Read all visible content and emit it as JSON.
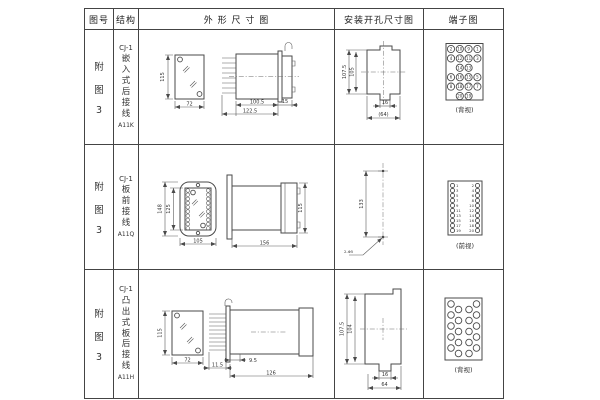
{
  "header": {
    "figure_col": "图号",
    "structure_col": "结构",
    "outline_col": "外 形 尺 寸 图",
    "mounting_col": "安装开孔尺寸图",
    "terminal_col": "端子图"
  },
  "rows": [
    {
      "figure": [
        "附",
        "图",
        "3"
      ],
      "structure": {
        "model": "CJ-1",
        "chars": [
          "嵌",
          "入",
          "式",
          "后",
          "接",
          "线"
        ],
        "code": "A11K"
      },
      "outline": {
        "front_height": "115",
        "front_width": "72",
        "side_top": "100.5",
        "side_bottom": "122.5",
        "side_right": "15"
      },
      "mounting": {
        "outer_height": "107.5",
        "inner_height": "105",
        "slot_width": "16",
        "overall_width": "(64)"
      },
      "terminal": {
        "view_label": "(背视)",
        "grid": [
          [
            "2",
            "10",
            "9",
            "1"
          ],
          [
            "4",
            "12",
            "11",
            "3"
          ],
          [
            "14",
            "13"
          ],
          [
            "6",
            "16",
            "15",
            "5"
          ],
          [
            "8",
            "18",
            "17",
            "7"
          ],
          [
            "20",
            "19"
          ]
        ]
      }
    },
    {
      "figure": [
        "附",
        "图",
        "3"
      ],
      "structure": {
        "model": "CJ-1",
        "chars": [
          "板",
          "前",
          "接",
          "线"
        ],
        "code": "A11Q"
      },
      "outline": {
        "front_outer_height": "148",
        "front_inner_height": "125",
        "front_width": "105",
        "side_length": "156",
        "side_height": "115"
      },
      "mounting": {
        "hole_spacing": "133",
        "hole_note": "2-Φ5"
      },
      "terminal": {
        "view_label": "(前视)",
        "left_numbers": [
          "1",
          "3",
          "5",
          "7",
          "9",
          "11",
          "13",
          "15",
          "17",
          "19"
        ],
        "right_numbers": [
          "2",
          "4",
          "6",
          "8",
          "10",
          "12",
          "14",
          "16",
          "18",
          "20"
        ]
      }
    },
    {
      "figure": [
        "附",
        "图",
        "3"
      ],
      "structure": {
        "model": "CJ-1",
        "chars": [
          "凸",
          "出",
          "式",
          "板",
          "后",
          "接",
          "线"
        ],
        "code": "A11H"
      },
      "outline": {
        "front_height": "115",
        "front_width": "72",
        "side_pin": "11.5",
        "side_gap": "9.5",
        "side_length": "126"
      },
      "mounting": {
        "outer_height": "107.5",
        "inner_height": "104",
        "slot_width": "16",
        "overall_width": "64"
      },
      "terminal": {
        "view_label": "(背视)"
      }
    }
  ],
  "colors": {
    "background": "#ffffff",
    "line": "#4a4a4a",
    "text": "#333333"
  }
}
